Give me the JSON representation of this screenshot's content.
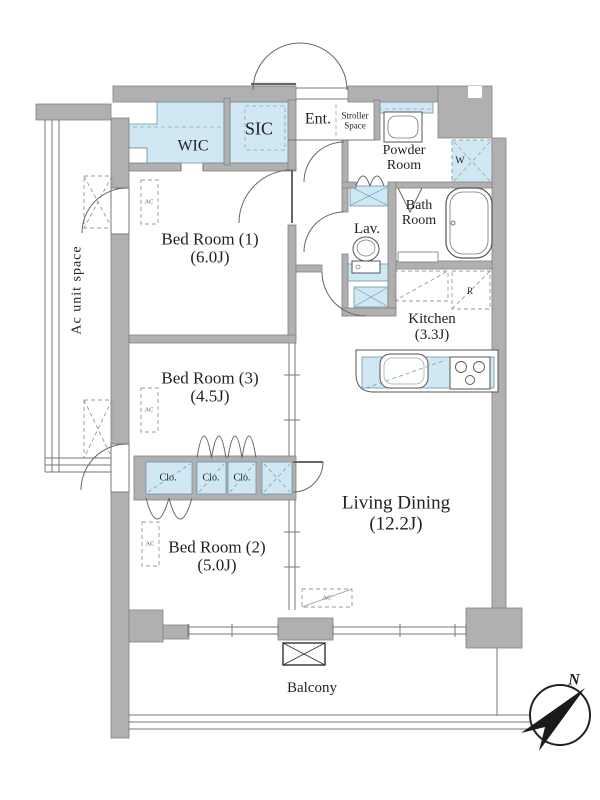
{
  "rooms": {
    "bedroom1": {
      "name": "Bed Room (1)",
      "size": "(6.0J)"
    },
    "bedroom2": {
      "name": "Bed Room (2)",
      "size": "(5.0J)"
    },
    "bedroom3": {
      "name": "Bed Room (3)",
      "size": "(4.5J)"
    },
    "living_dining": {
      "name": "Living Dining",
      "size": "(12.2J)"
    },
    "kitchen": {
      "name": "Kitchen",
      "size": "(3.3J)"
    },
    "bath": {
      "line1": "Bath",
      "line2": "Room"
    },
    "powder": {
      "line1": "Powder",
      "line2": "Room"
    },
    "lavatory": {
      "name": "Lav."
    },
    "wic": {
      "name": "WIC"
    },
    "sic": {
      "name": "SIC"
    },
    "entrance": {
      "name": "Ent."
    },
    "stroller": {
      "line1": "Stroller",
      "line2": "Space"
    },
    "balcony": {
      "name": "Balcony"
    },
    "ac_unit_space": {
      "name": "Ac unit space"
    }
  },
  "closets": {
    "c1": "Clo.",
    "c2": "Clo.",
    "c3": "Clo."
  },
  "fixtures": {
    "washer": "W",
    "refrigerator": "R",
    "air_conditioner": "AC"
  },
  "compass": {
    "north": "N"
  },
  "colors": {
    "wall": "#b0b0b0",
    "room_fill": "#cfe8f4",
    "line": "#555555",
    "text": "#222222"
  }
}
